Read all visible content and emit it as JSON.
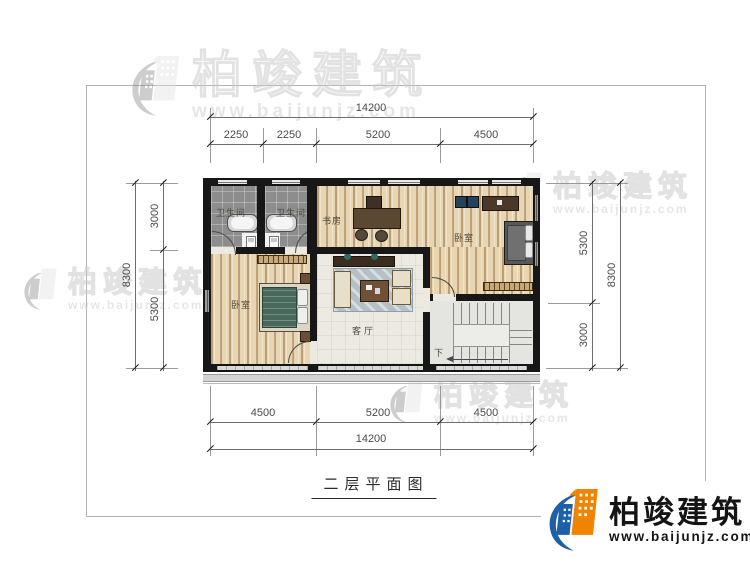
{
  "meta": {
    "caption": "二层平面图"
  },
  "brand": {
    "name": "柏竣建筑",
    "website": "www.baijunjz.com",
    "logo_blue": "#1d5fa8",
    "logo_orange": "#f08300"
  },
  "watermark": {
    "name": "柏竣建筑",
    "website": "www.baijunjz.com"
  },
  "rooms": {
    "bathroom_left": "卫生间",
    "bathroom_right": "卫生间",
    "study": "书房",
    "bedroom_top_right": "卧室",
    "bedroom_bottom_left": "卧室",
    "living_room": "客厅",
    "stair_direction": "下"
  },
  "dimensions": {
    "top": {
      "total": "14200",
      "segments": [
        "2250",
        "2250",
        "5200",
        "4500"
      ]
    },
    "bottom": {
      "total": "14200",
      "segments": [
        "4500",
        "5200",
        "4500"
      ]
    },
    "left": {
      "total": "8300",
      "segments": [
        "3000",
        "5300"
      ]
    },
    "right": {
      "total": "8300",
      "segments": [
        "5300",
        "3000"
      ]
    }
  }
}
